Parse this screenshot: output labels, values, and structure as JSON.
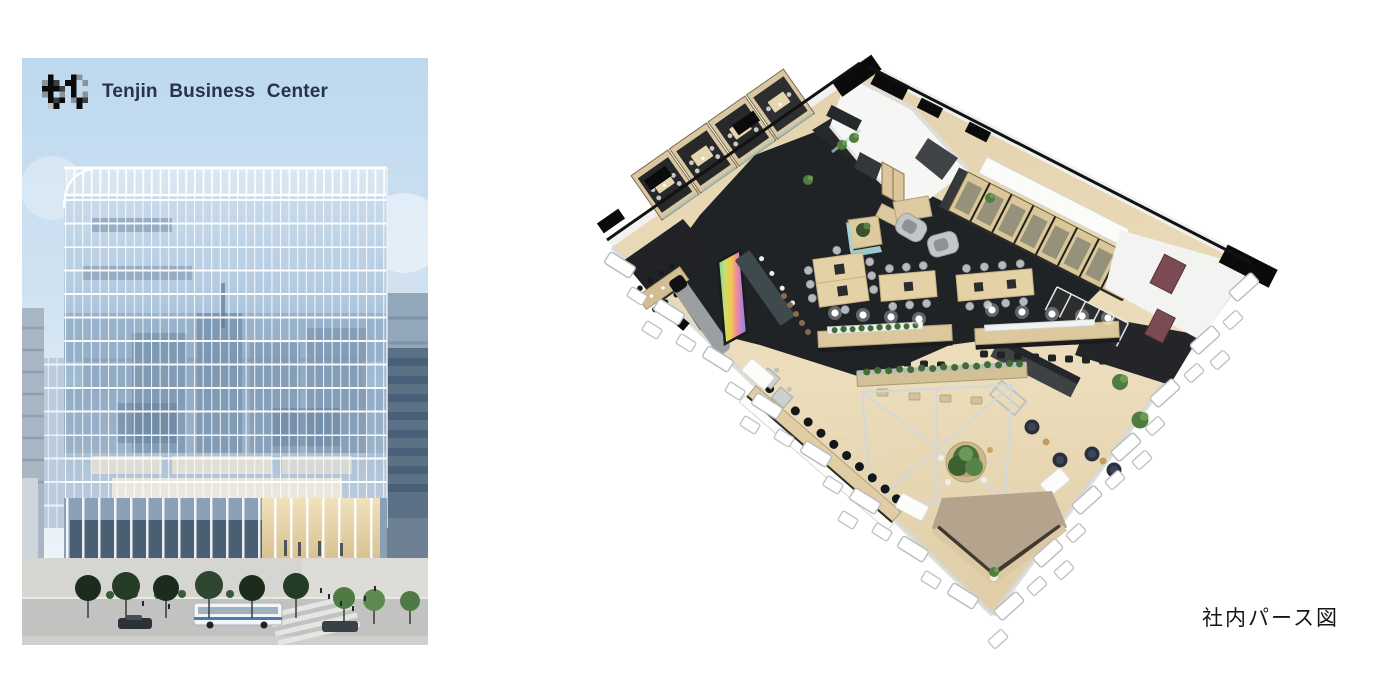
{
  "brand": {
    "title": "Tenjin Business Center",
    "logo_icon": "bc-pixel-logo-icon",
    "title_color": "#273349"
  },
  "figures": {
    "exterior": {
      "kind": "building-exterior-render"
    },
    "interior": {
      "kind": "office-floorplan-isometric-render",
      "caption": "社内パース図"
    }
  },
  "palette": {
    "sky_top": "#bdd8ee",
    "sky_low": "#eaf2f9",
    "glass": "#a9c3dc",
    "mullion": "#ffffff",
    "wood_floor": "#e7d7b5",
    "carpet_dark": "#202326",
    "accent_teal": "#a9d2d4",
    "accent_burgundy": "#7c4a52",
    "plant_green": "#4f7d3f",
    "rug_tan": "#b4a48d",
    "caption_color": "#161616"
  }
}
